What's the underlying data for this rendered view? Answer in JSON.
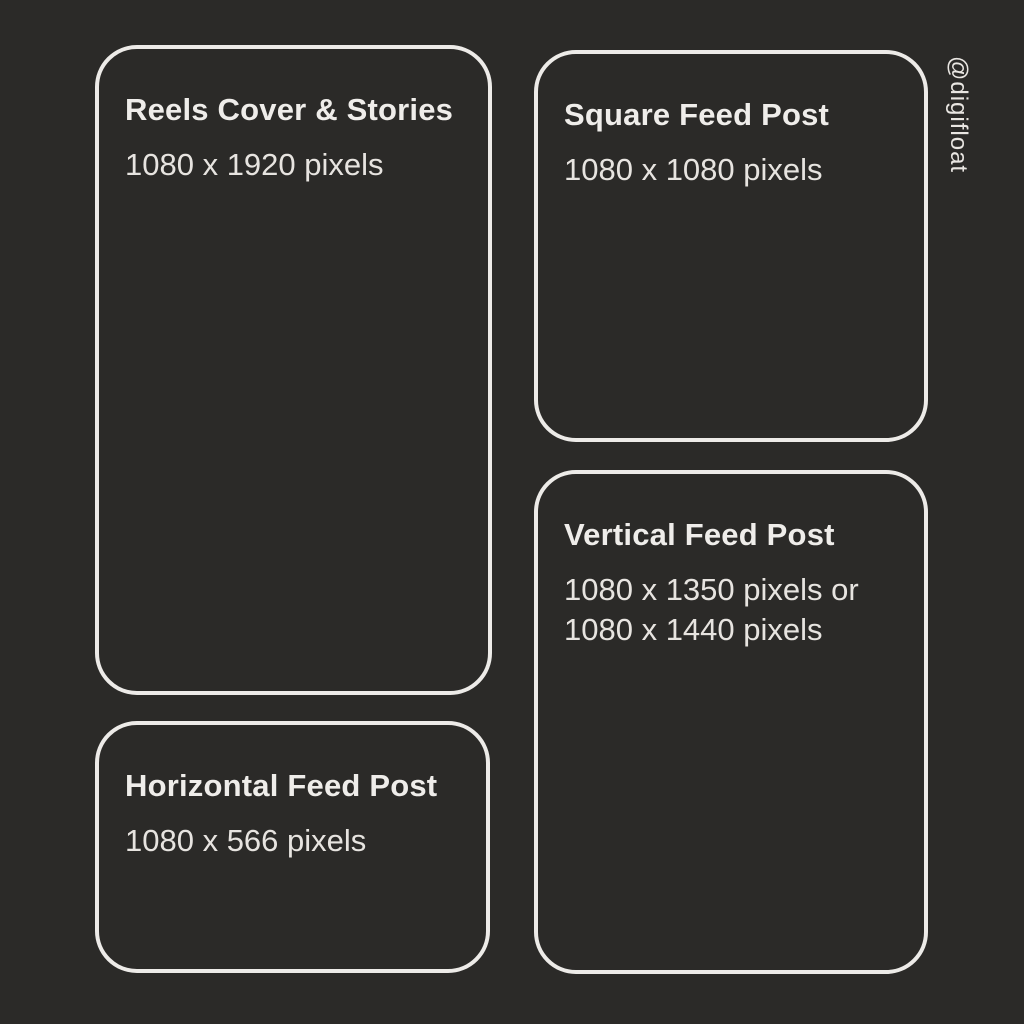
{
  "theme": {
    "background_color": "#2b2a28",
    "outline_color": "#edebe8",
    "title_color": "#efedea",
    "size_text_color": "#e7e4e0"
  },
  "watermark": {
    "handle": "@digifloat"
  },
  "cards": [
    {
      "id": "reels-cover-stories",
      "title": "Reels Cover & Stories",
      "size": "1080 x 1920 pixels"
    },
    {
      "id": "square-feed-post",
      "title": "Square Feed Post",
      "size": "1080 x 1080 pixels"
    },
    {
      "id": "vertical-feed-post",
      "title": "Vertical Feed Post",
      "size_line1": "1080 x 1350 pixels or",
      "size_line2": "1080 x 1440 pixels"
    },
    {
      "id": "horizontal-feed-post",
      "title": "Horizontal Feed Post",
      "size": "1080 x 566 pixels"
    }
  ]
}
